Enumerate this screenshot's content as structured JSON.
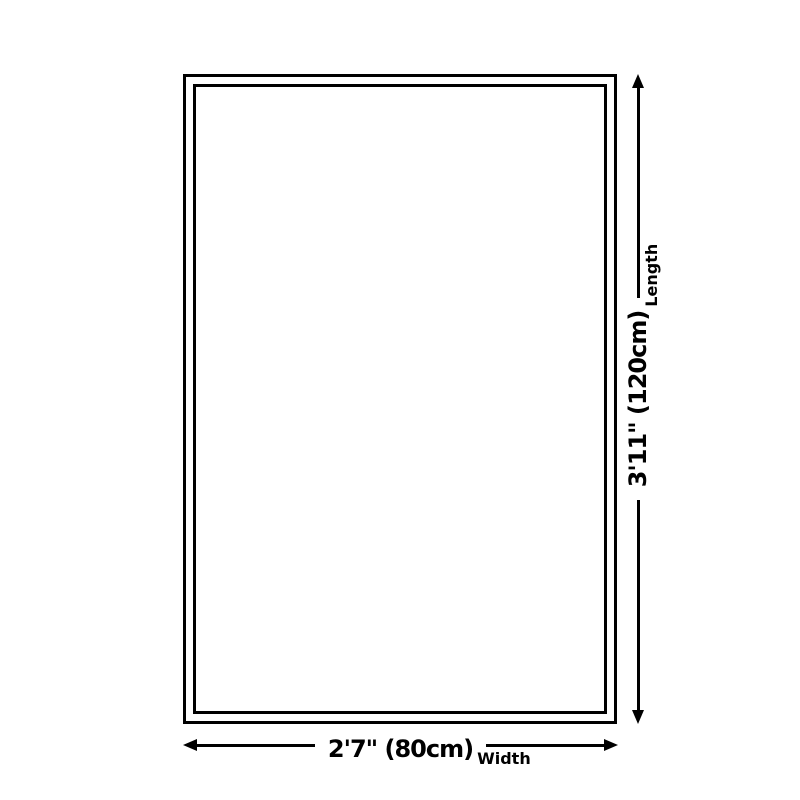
{
  "page": {
    "background_color": "#ffffff",
    "line_color": "#000000"
  },
  "diagram": {
    "type": "product-size-diagram",
    "shape": "rectangle",
    "length": {
      "value": "3'11\" (120cm)",
      "label": "Length"
    },
    "width": {
      "value": "2'7\" (80cm)",
      "label": "Width"
    }
  }
}
